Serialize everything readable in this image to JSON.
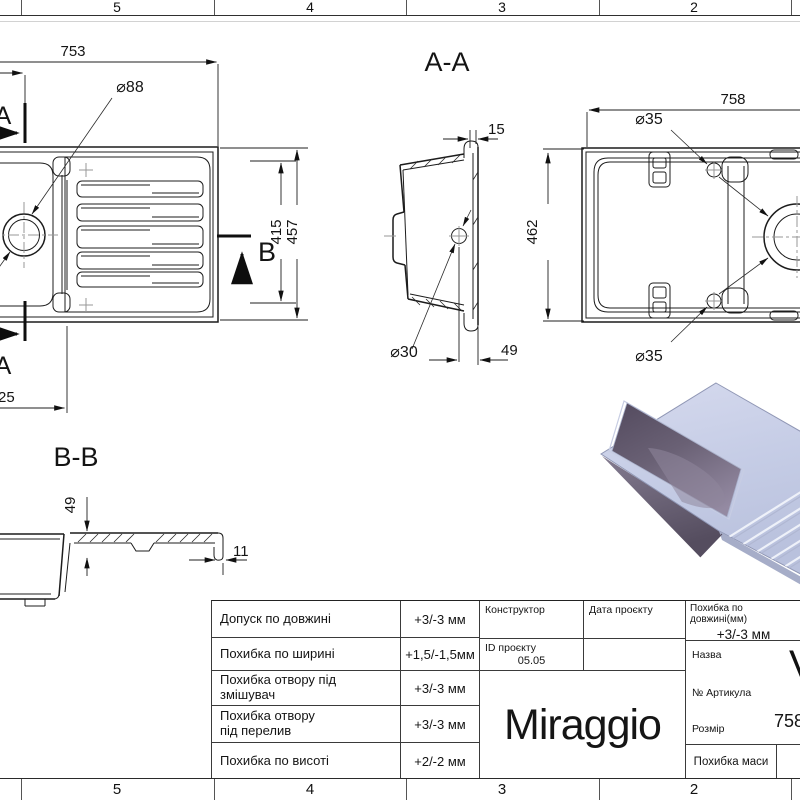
{
  "rulers": {
    "top": [
      "5",
      "4",
      "3",
      "2"
    ],
    "bottom": [
      "5",
      "4",
      "3",
      "2"
    ]
  },
  "top_view": {
    "dim_length": "753",
    "dim_drain_hole": "⌀88",
    "dim_width_inner": "415",
    "dim_width_outer": "457",
    "dim_offset": "25",
    "section_a_top": "A",
    "section_a_bottom": "A",
    "section_b": "B"
  },
  "section_aa": {
    "title": "A-A",
    "dim_rim": "15",
    "dim_hole": "⌀30",
    "dim_hole_to_edge": "49"
  },
  "bottom_view": {
    "dim_length": "758",
    "dim_width": "462",
    "dim_hole_top": "⌀35",
    "dim_hole_bottom": "⌀35"
  },
  "section_bb": {
    "title": "B-B",
    "dim_depth": "49",
    "dim_wall": "11"
  },
  "title_block": {
    "tolerances": [
      {
        "label": "Допуск по довжині",
        "value": "+3/-3 мм"
      },
      {
        "label": "Похибка по ширині",
        "value": "+1,5/-1,5мм"
      },
      {
        "label": "Похибка отвору під\nзмішувач",
        "value": "+3/-3 мм"
      },
      {
        "label": "Похибка отвору\nпід перелив",
        "value": "+3/-3 мм"
      },
      {
        "label": "Похибка по висоті",
        "value": "+2/-2 мм"
      }
    ],
    "constructor_label": "Конструктор",
    "project_date_label": "Дата проєкту",
    "project_id_label": "ID проєкту",
    "project_id_value": "05.05",
    "brand": "Miraggio",
    "length_tolerance_label": "Похибка по довжині(мм)",
    "length_tolerance_value": "+3/-3 мм",
    "name_label": "Назва",
    "name_value_partial": "V",
    "article_label": "№ Артикула",
    "size_label": "Розмір",
    "size_value_partial": "758",
    "mass_tolerance_label": "Похибка маси"
  },
  "render_colors": {
    "rim_top": "#c6cde6",
    "bowl_interior": "#6a6175",
    "bowl_exterior": "#6e6679",
    "groove_highlight": "#eef1f9"
  }
}
